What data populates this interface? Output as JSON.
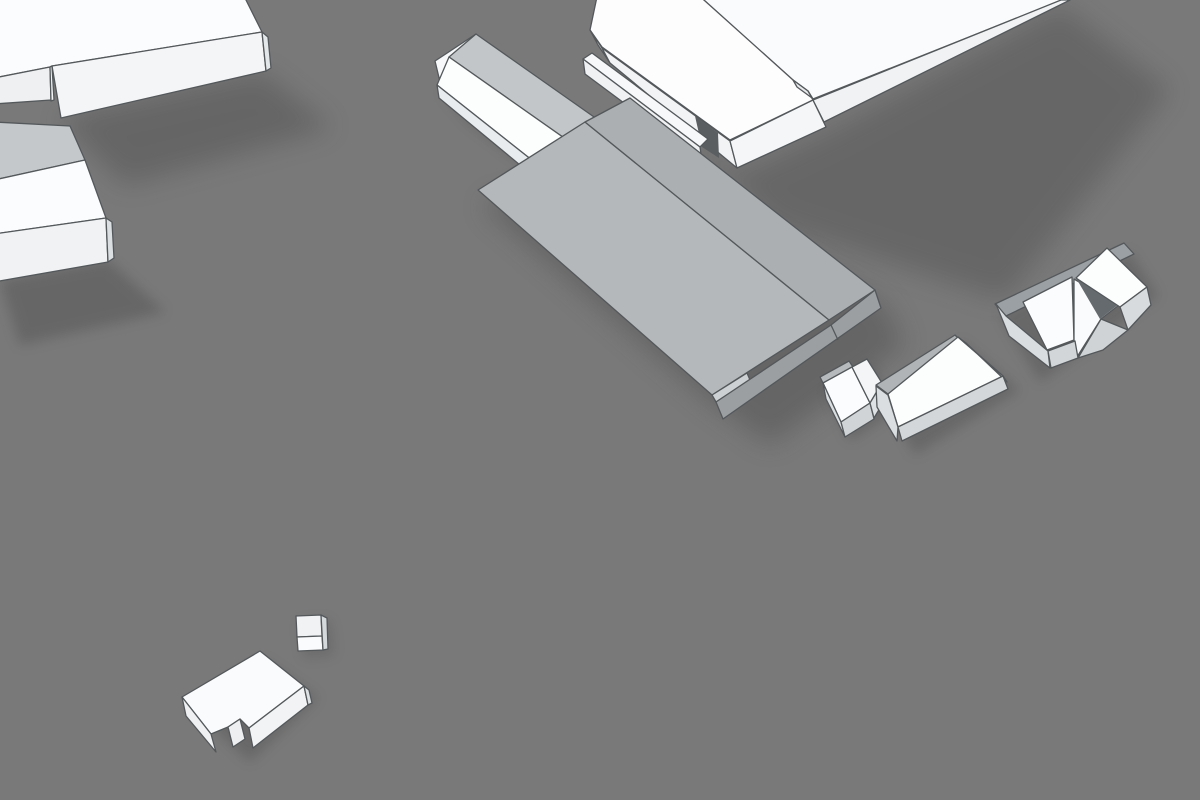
{
  "scene": {
    "description": "3d-building-massing-scene",
    "canvas": {
      "width": 1200,
      "height": 800
    },
    "stroke_width": 1.3,
    "colors": {
      "background": "#797979",
      "outline": "#54585b",
      "shadow": "#3d3d3d",
      "highlight_roof": "#b5b8ba",
      "white_top": "#fbfcfd"
    },
    "shadows": [
      {
        "of": "slab-top-left",
        "points": "58,118 262,72 332,128 125,185",
        "opacity": 0.32,
        "blur": "big"
      },
      {
        "of": "house-gable-left",
        "points": "0,280 108,260 165,312 20,345",
        "opacity": 0.3,
        "blur": "soft"
      },
      {
        "of": "hall-gable-long",
        "points": "438,88 580,200 612,232 468,122",
        "opacity": 0.28,
        "blur": "soft"
      },
      {
        "of": "slab-top-right",
        "points": "612,68 740,172 830,130 1062,6 1170,90 1005,300 775,225",
        "opacity": 0.3,
        "blur": "big"
      },
      {
        "of": "building-large-highlighted",
        "points": "482,205 710,402 770,445 905,345 885,305 635,155",
        "opacity": 0.33,
        "blur": "big"
      },
      {
        "of": "house-small-l",
        "points": "826,390 872,366 896,410 850,441",
        "opacity": 0.28,
        "blur": "soft"
      },
      {
        "of": "house-gable-mid",
        "points": "882,395 962,342 1020,390 915,455",
        "opacity": 0.28,
        "blur": "soft"
      },
      {
        "of": "house-complex-right",
        "points": "1000,315 1130,252 1158,296 1040,382",
        "opacity": 0.28,
        "blur": "soft"
      },
      {
        "of": "kiosk-flat-small",
        "points": "300,622 330,620 334,655 304,658",
        "opacity": 0.22,
        "blur": "soft"
      },
      {
        "of": "block-low-notched",
        "points": "190,706 264,660 318,698 250,762",
        "opacity": 0.28,
        "blur": "soft"
      }
    ],
    "buildings": [
      {
        "id": "slab-top-left",
        "state": "default",
        "polys": [
          {
            "part": "roof-top",
            "points": "-6,-6 243,-6 262,32 52,66 50,67 -6,78",
            "fill": "#fbfcfd"
          },
          {
            "part": "wall-front",
            "points": "52,66 262,32 266,71 61,118",
            "fill": "#f4f5f7"
          },
          {
            "part": "wall-end-right",
            "points": "262,32 268,37 271,68 266,71",
            "fill": "#e4e7e9"
          },
          {
            "part": "wall-left-low",
            "points": "-6,78 50,67 51,100 -6,104",
            "fill": "#eef0f1"
          },
          {
            "part": "notch-step",
            "points": "50,67 52,66 54,100 51,101",
            "fill": "#f3f5f6"
          }
        ]
      },
      {
        "id": "house-gable-left",
        "state": "default",
        "polys": [
          {
            "part": "roof-far",
            "points": "-6,122 70,126 85,160 -6,180",
            "fill": "#c5c8ca"
          },
          {
            "part": "roof-near",
            "points": "-6,180 85,160 106,218 -6,234",
            "fill": "#fbfcfd"
          },
          {
            "part": "wall-front",
            "points": "-6,234 106,218 108,262 -6,282",
            "fill": "#f0f2f3"
          },
          {
            "part": "wall-side-right",
            "points": "106,218 112,222 114,258 108,262",
            "fill": "#dcdfe1"
          }
        ]
      },
      {
        "id": "hall-gable-long",
        "state": "default",
        "polys": [
          {
            "part": "gable-end",
            "points": "435,61 476,34 441,86",
            "fill": "#f6f8f9"
          },
          {
            "part": "roof-far",
            "points": "476,34 604,124 577,147 449,57",
            "fill": "#c3c6c8"
          },
          {
            "part": "roof-near",
            "points": "449,57 577,147 547,172 437,85",
            "fill": "#fcfdfd"
          },
          {
            "part": "wall-eave",
            "points": "437,85 547,172 543,184 439,98",
            "fill": "#e9ecee"
          }
        ]
      },
      {
        "id": "slab-top-right",
        "state": "default",
        "polys": [
          {
            "part": "roof-main",
            "points": "695,-8 793,80 808,91 813,99 1062,0 1068,-8",
            "fill": "#fafbfc"
          },
          {
            "part": "roof-wing",
            "points": "598,-8 590,30 602,47 730,140 813,100 808,91 793,80 695,-8",
            "fill": "#fdfdfe"
          },
          {
            "part": "step-face",
            "points": "793,80 808,91 812,98 797,87",
            "fill": "#e7e9eb"
          },
          {
            "part": "wall-end-left",
            "points": "590,30 602,48 610,63 598,45",
            "fill": "#eceef0"
          },
          {
            "part": "wall-wing-left",
            "points": "602,48 730,141 737,168 610,63",
            "fill": "#f2f3f5"
          },
          {
            "part": "wall-wing-right",
            "points": "730,141 813,100 826,127 737,168",
            "fill": "#f5f6f8"
          },
          {
            "part": "wall-main-front",
            "points": "813,100 1061,0 1070,0 824,122",
            "fill": "#f0f2f4"
          }
        ]
      },
      {
        "id": "annex-bar",
        "state": "default",
        "polys": [
          {
            "part": "gap-slot",
            "points": "695,116 718,133 719,158 702,147",
            "fill": "#5a5e61",
            "stroke": false
          },
          {
            "part": "roof-top",
            "points": "583,59 592,53 708,139 700,147",
            "fill": "#f7f8fa"
          },
          {
            "part": "wall-front",
            "points": "583,59 700,147 702,161 585,74",
            "fill": "#eff1f3"
          }
        ]
      },
      {
        "id": "building-large-highlighted",
        "state": "highlighted",
        "polys": [
          {
            "part": "roof-slope-left",
            "points": "478,190 585,122 829,320 712,395",
            "fill": "#b5b8ba"
          },
          {
            "part": "roof-slope-right",
            "points": "585,122 630,98 875,290 829,320",
            "fill": "#acafb2"
          },
          {
            "part": "eave-sliver",
            "points": "712,395 747,373 750,380 716,402",
            "fill": "#ced1d3"
          },
          {
            "part": "wall-gable-end",
            "points": "716,402 831,325 875,290 881,308 723,419",
            "fill": "#9b9fa2"
          }
        ],
        "lines": [
          {
            "x1": 831,
            "y1": 325,
            "x2": 838,
            "y2": 340
          }
        ]
      },
      {
        "id": "house-small-l",
        "state": "default",
        "polys": [
          {
            "part": "roof-far-band",
            "points": "820,377 849,361 853,367 823,383",
            "fill": "#b7babc"
          },
          {
            "part": "roof-main",
            "points": "823,383 852,367 870,403 841,422",
            "fill": "#fbfcfd"
          },
          {
            "part": "roof-wing",
            "points": "852,367 867,359 882,383 870,403",
            "fill": "#f3f5f6"
          },
          {
            "part": "wall-left",
            "points": "823,383 841,422 845,437 826,399",
            "fill": "#dbdee0"
          },
          {
            "part": "wall-front",
            "points": "841,422 870,403 874,419 845,437",
            "fill": "#d1d4d6"
          },
          {
            "part": "wall-end-right",
            "points": "870,403 882,383 886,398 874,418",
            "fill": "#dfe2e4"
          }
        ]
      },
      {
        "id": "house-gable-mid",
        "state": "default",
        "polys": [
          {
            "part": "roof-far-band",
            "points": "876,385 955,335 960,340 888,394",
            "fill": "#b1b4b6"
          },
          {
            "part": "roof-main",
            "points": "888,394 958,337 1003,376 898,427",
            "fill": "#fcfdfd"
          },
          {
            "part": "wall-end-right",
            "points": "958,337 966,343 1007,382 1003,376",
            "fill": "#cfd2d4"
          },
          {
            "part": "wall-left",
            "points": "876,386 888,395 898,427 897,441 877,407",
            "fill": "#dbdee0"
          },
          {
            "part": "wall-front",
            "points": "898,427 1003,376 1008,389 902,441",
            "fill": "#d4d7d9"
          }
        ]
      },
      {
        "id": "house-complex-right",
        "state": "default",
        "polys": [
          {
            "part": "roof-far-band",
            "points": "995,304 1124,243 1134,254 1006,316",
            "fill": "#9ba0a4"
          },
          {
            "part": "roof-slope-left",
            "points": "1023,302 1072,277 1074,340 1047,350",
            "fill": "#fbfcfd"
          },
          {
            "part": "roof-slope-mid",
            "points": "1074,279 1119,305 1101,319 1077,357 1074,340",
            "fill": "#fafbfc"
          },
          {
            "part": "valley-shadow",
            "points": "1076,278 1119,304 1100,319",
            "fill": "#646a6e",
            "stroke": false
          },
          {
            "part": "roof-gable-right",
            "points": "1076,278 1107,248 1147,287 1120,307",
            "fill": "#fcfdfd"
          },
          {
            "part": "wall-end-right",
            "points": "1147,287 1151,305 1128,330 1120,307",
            "fill": "#d8dbdd"
          },
          {
            "part": "wall-left-group",
            "points": "996,304 1006,316 1048,351 1050,368 1009,336",
            "fill": "#dadde0"
          },
          {
            "part": "wall-mid-front",
            "points": "1048,351 1075,341 1078,358 1051,368",
            "fill": "#d3d6d8"
          },
          {
            "part": "wall-right-front",
            "points": "1101,319 1128,330 1103,350 1078,358",
            "fill": "#cfd3d5"
          }
        ]
      },
      {
        "id": "kiosk-flat-small",
        "state": "default",
        "polys": [
          {
            "part": "face-upper",
            "points": "296,616 321,615 322,636 297,637",
            "fill": "#f0f2f4"
          },
          {
            "part": "face-lower",
            "points": "297,637 322,636 323,650 298,651",
            "fill": "#fafbfc"
          },
          {
            "part": "side-right",
            "points": "321,615 327,618 328,649 323,650",
            "fill": "#d6d9db"
          }
        ]
      },
      {
        "id": "block-low-notched",
        "state": "default",
        "polys": [
          {
            "part": "roof-top",
            "points": "182,697 260,651 304,686 249,728 240,719 228,727 211,734",
            "fill": "#fafbfc"
          },
          {
            "part": "wall-left",
            "points": "182,697 211,734 216,752 186,716",
            "fill": "#eef0f2"
          },
          {
            "part": "wall-front",
            "points": "249,728 304,686 308,705 253,748",
            "fill": "#f1f3f4"
          },
          {
            "part": "wall-notch",
            "points": "228,727 240,719 245,739 233,747",
            "fill": "#edeff1"
          },
          {
            "part": "side-right",
            "points": "304,686 309,690 312,703 308,705",
            "fill": "#dfe2e4"
          }
        ]
      }
    ]
  }
}
